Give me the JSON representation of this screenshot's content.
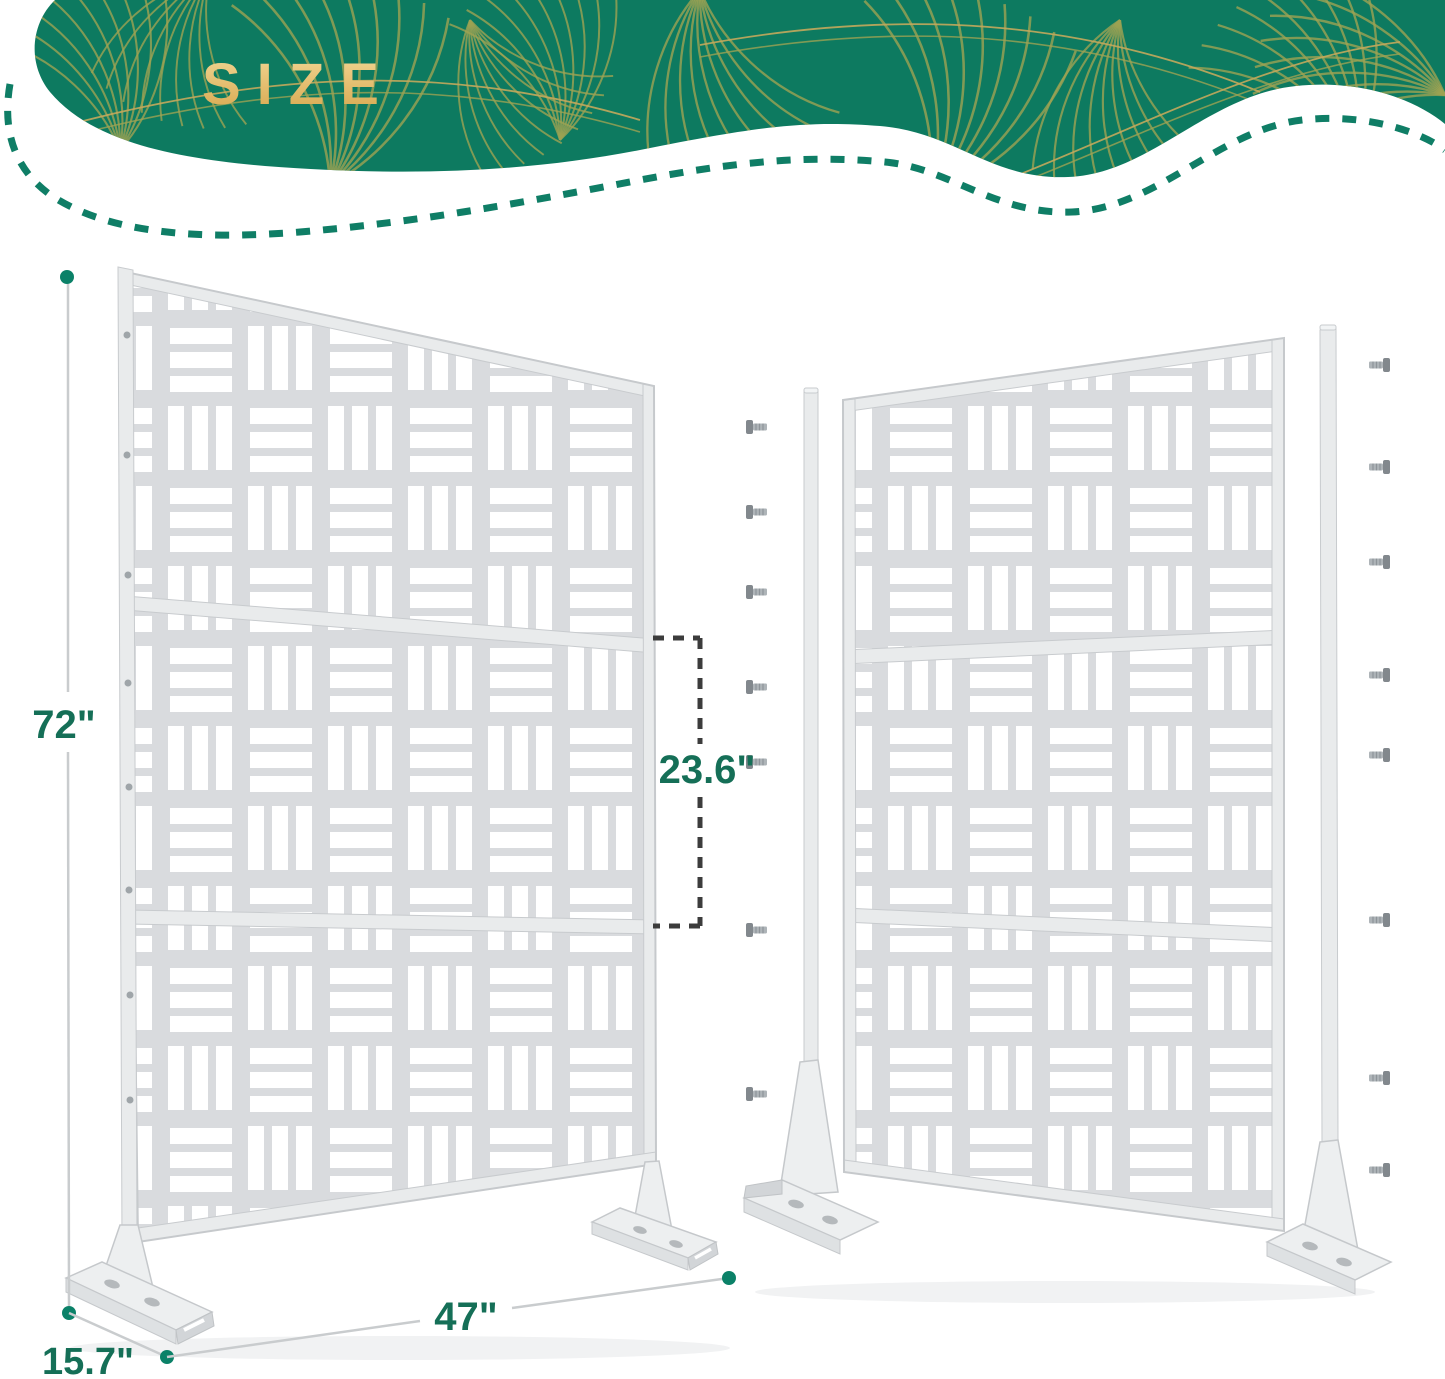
{
  "banner": {
    "title": "SIZE",
    "background_color": "#0D7A60",
    "leaf_line_color": "#9DA253",
    "title_gradient_top": "#F2D795",
    "title_gradient_bottom": "#D6A64C",
    "dashed_outline_color": "#0F7E66"
  },
  "diagram": {
    "dimensions": {
      "height": {
        "label": "72\""
      },
      "width": {
        "label": "47\""
      },
      "depth": {
        "label": "15.7\""
      },
      "middle_panel": {
        "label": "23.6\""
      }
    },
    "label_color": "#156F57",
    "endpoint_dot_color": "#0B8168",
    "bracket_dash_color": "#3C3C3C"
  },
  "screens": {
    "panel_color": "#D9DBDE",
    "cutout_color": "#FFFFFF",
    "sections_per_screen": 3,
    "left_screen_view": "assembled",
    "right_screen_view": "exploded",
    "right_screen_screws_left_column": 7,
    "right_screen_screws_right_column": 8
  }
}
